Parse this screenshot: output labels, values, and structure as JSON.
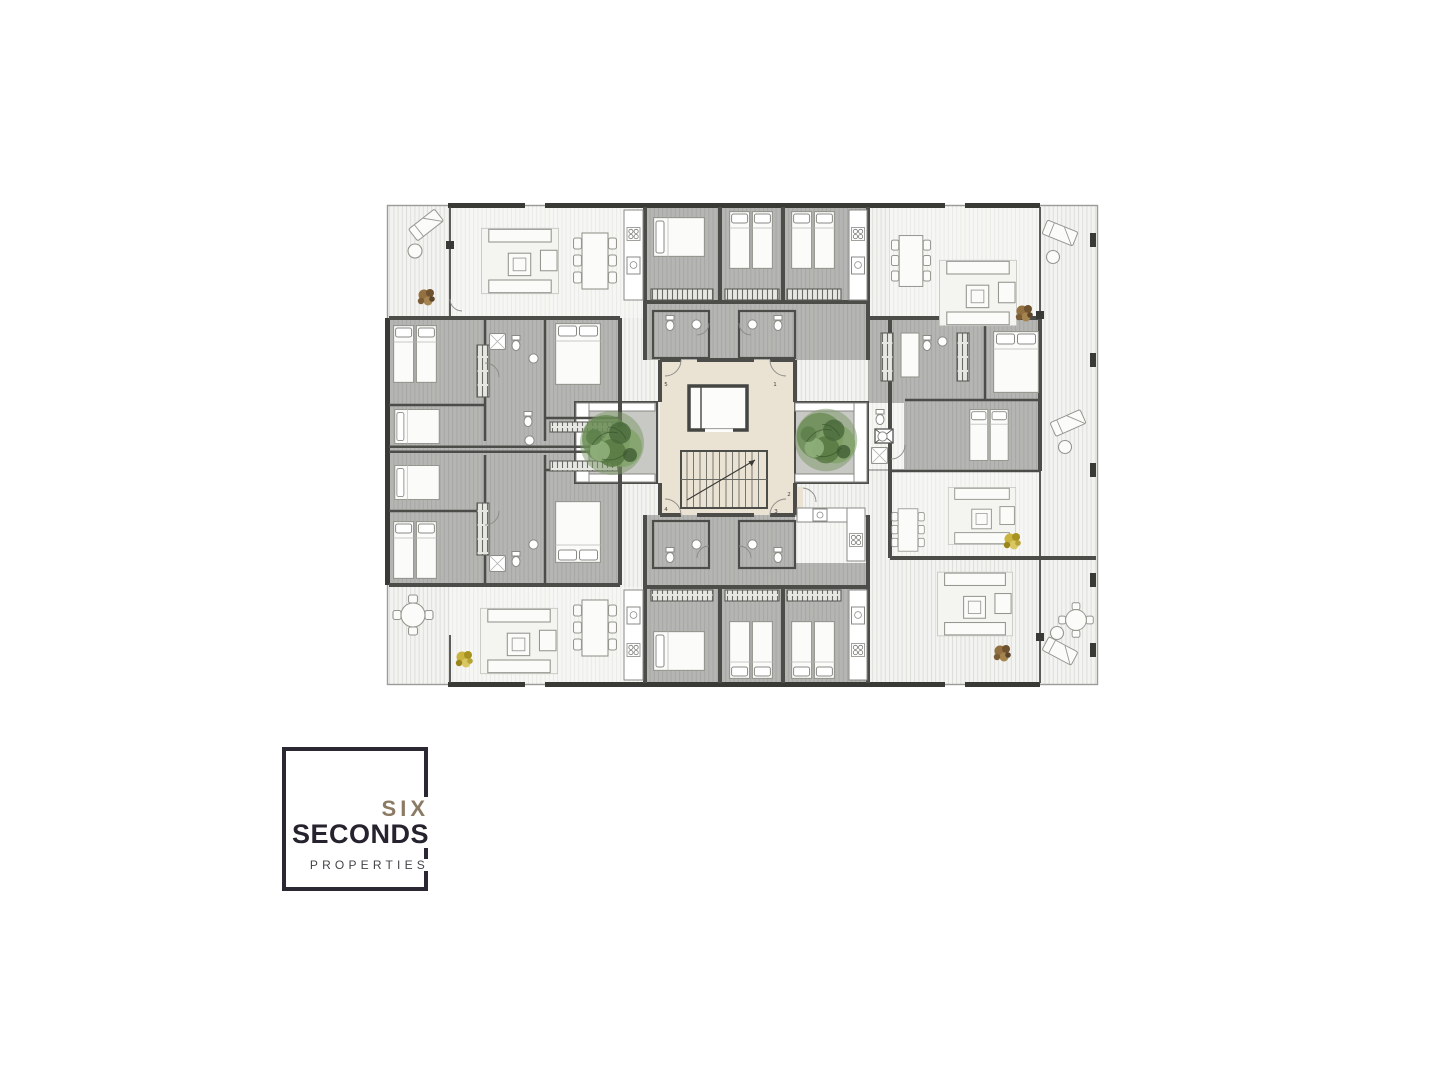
{
  "brand": {
    "line1": "SIX",
    "line2": "SECONDS",
    "line3": "PROPERTIES"
  },
  "floorplan": {
    "units": [
      {
        "label": "1"
      },
      {
        "label": "2"
      },
      {
        "label": "3"
      },
      {
        "label": "4"
      },
      {
        "label": "5"
      }
    ],
    "colors": {
      "wall": "#4c4c49",
      "wallDark": "#393936",
      "terrace": "#f3f3f1",
      "terraceStripe": "#dcdcd7",
      "living": "#f6f6f4",
      "livingStripe": "#e9e9e4",
      "room": "#b5b5b3",
      "roomStripe": "#a6a6a3",
      "core": "#eae2d2",
      "patio": "#c8c8c4",
      "furn": "#fbfbfa",
      "furnStroke": "#96968f",
      "tree": "#668a50",
      "plantBrown": "#93703f",
      "plantYellow": "#c9b43f"
    }
  }
}
